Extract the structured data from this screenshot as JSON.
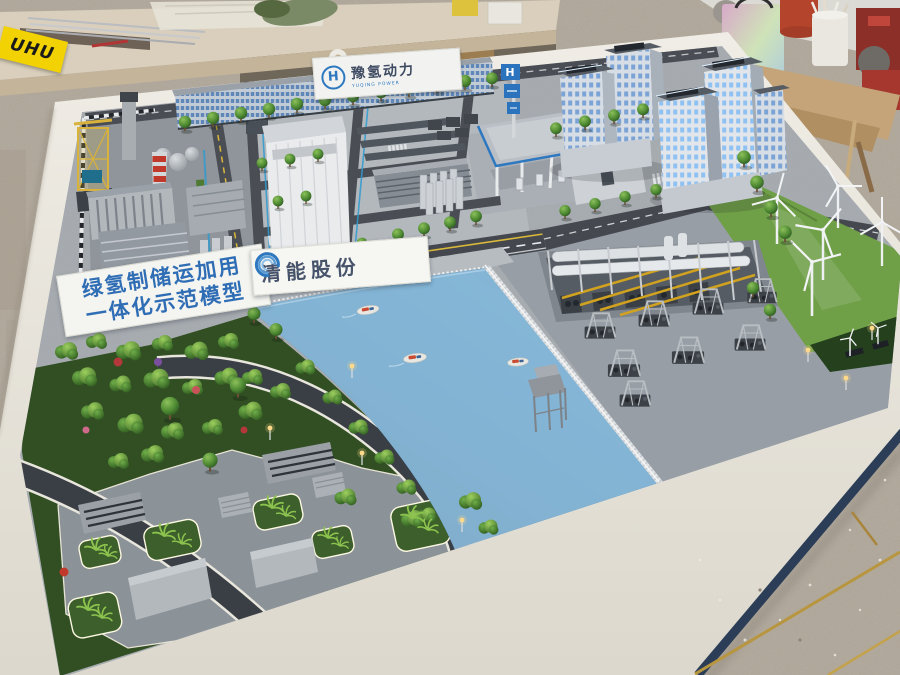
{
  "scene": {
    "alt": "Photograph of a physical scale model of a green-hydrogen industrial park (power plant, hydrogen storage, refueling station, river, wind farm, park and high-rises) on a white display table in a model-making workshop"
  },
  "signs": {
    "demo": {
      "line1": "绿氢制储运加用",
      "line2": "一体化示范模型"
    },
    "company": {
      "name": "清能股份"
    },
    "gate": {
      "name": "豫氢动力",
      "sub": "YUQING POWER",
      "logo_letter": "H"
    },
    "station_sign": {
      "logo_letter": "H"
    },
    "glue_box": {
      "brand": "UHU"
    }
  },
  "colors": {
    "table_frame": "#e9e6de",
    "table_skirt": "#2c3e57",
    "workshop_floor": "#b0a79a",
    "water_deep": "#0a3e72",
    "water_bright": "#1d74bc",
    "park_grass": "#314f23",
    "wind_grass": "#6f9f47",
    "road": "#45494f",
    "road_marking": "#e8eaec",
    "road_yellow": "#d9b83a",
    "logo_blue": "#2e78c0",
    "sign_text_blue": "#2f6db5",
    "crane_yellow": "#d8b23a",
    "chimney_stripe": "#c0392b",
    "pipe_yellow": "#d0a21f",
    "window_blue": "#7ba3d6",
    "lamp_glow": "#ffd98a"
  }
}
